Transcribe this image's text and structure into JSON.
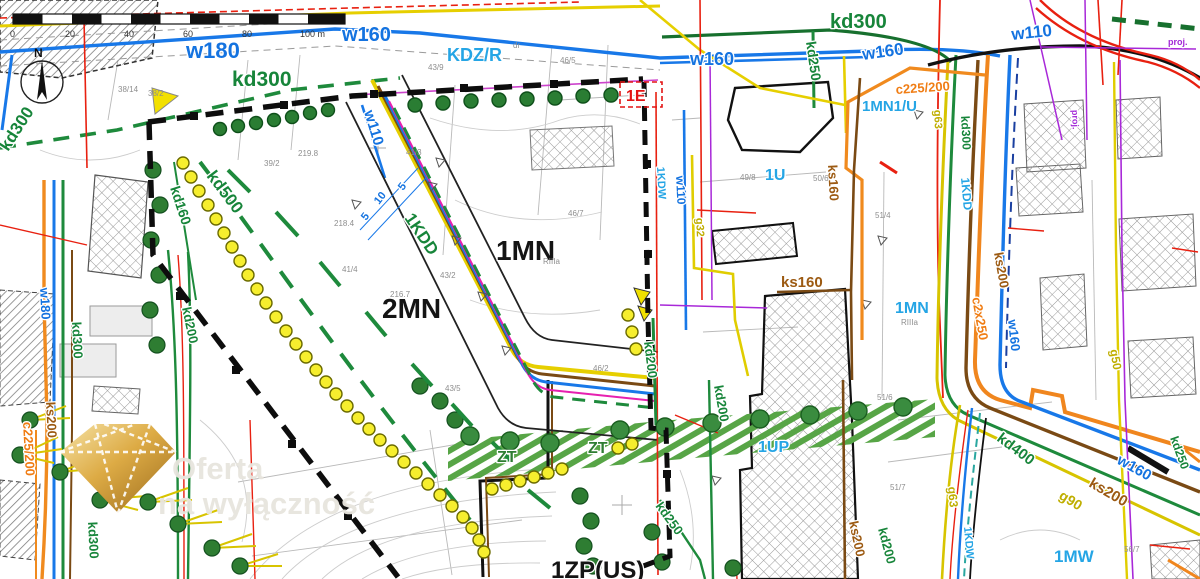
{
  "scalebar": {
    "t0": "0",
    "t1": "20",
    "t2": "40",
    "t3": "60",
    "t4": "80",
    "t5": "100 m"
  },
  "compass": {
    "n": "N"
  },
  "watermark": {
    "line1": "Oferta",
    "line2": "na wyłączność"
  },
  "zones": {
    "mn1": "1MN",
    "mn2": "2MN",
    "u1": "1U",
    "mn1u": "1MN1/U",
    "mn1r": "1MN",
    "up1": "1UP",
    "mw1": "1MW",
    "zp1": "1ZP(US)",
    "zta": "ZT",
    "ztb": "ZT",
    "e1": "1E",
    "kdzr": "KDZ/R",
    "kdd_diag": "1KDD",
    "kdd_right": "1KDD",
    "kdw_mid": "1KDW",
    "kdw_br": "1KDW",
    "riiia_a": "RIIIa",
    "riiia_b": "RIIIa"
  },
  "utilities": {
    "w180_top": "w180",
    "w160_top": "w160",
    "w110_diag": "w110",
    "w160_mid": "w160",
    "w160_tr": "w160",
    "w110_tr": "w110",
    "w160_rv": "w160",
    "w160_br": "w160",
    "w180_lv": "w180",
    "w110_mv": "w110",
    "kd300_tl": "kd300",
    "kd300_ld": "kd300",
    "kd300_tr": "kd300",
    "kd250_tr": "kd250",
    "kd300_rv": "kd300",
    "kd500": "kd500",
    "kd160": "kd160",
    "kd200_l": "kd200",
    "kd300_lv": "kd300",
    "kd300_ll": "kd300",
    "kd200_m": "kd200",
    "kd200_up": "kd200",
    "kd200_br": "kd200",
    "kd250_b": "kd250",
    "kd250_br": "kd250",
    "kd400": "kd400",
    "ks200_r": "ks200",
    "ks160_v": "ks160",
    "ks160_h": "ks160",
    "ks200_l": "ks200",
    "ks200_b": "ks200",
    "ks200_br": "ks200",
    "c225_tr": "c225/200",
    "c225_l": "c225/200",
    "c2x250": "c2x250",
    "g63_tr": "g63",
    "g50": "g50",
    "g32": "g32",
    "g90": "g90",
    "g63_br": "g63",
    "proj_a": "proj.",
    "proj_b": "proj."
  },
  "dims": {
    "d5a": "5",
    "d10": "10",
    "d5b": "5"
  },
  "parcels": {
    "p1": "38/14",
    "p2": "38/2",
    "p3": "39/2",
    "p4": "43/9",
    "p5": "46/5",
    "p6": "41/3",
    "p7": "41/4",
    "p8": "43/2",
    "p9": "46/7",
    "p10": "46/2",
    "p11": "43/5",
    "p12": "49/8",
    "p13": "50/6",
    "p14": "51/4",
    "p15": "51/6",
    "p16": "51/7",
    "p17": "56/7",
    "p18": "216.7",
    "p19": "218.4",
    "p20": "219.8",
    "p21": "dr"
  }
}
